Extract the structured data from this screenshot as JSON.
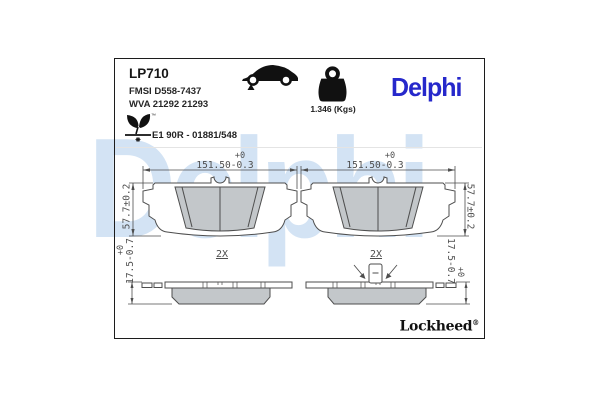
{
  "watermark": "Delphi",
  "header": {
    "part_number": "LP710",
    "fmsi": "FMSI D558-7437",
    "wva": "WVA 21292 21293",
    "weight": "1.346 (Kgs)",
    "brand_logo": "Delphi",
    "leaf_tm": "™",
    "approval": "E1 90R - 01881/548"
  },
  "drawing": {
    "width_tol_plus": "+0",
    "width_value": "151.50",
    "width_tol_minus": "-0.3",
    "height_value": "57.7±0.2",
    "thickness_tol_plus": "+0",
    "thickness_value": "17.5",
    "thickness_tol_minus": "-0.7",
    "quantity": "2X"
  },
  "footer": {
    "sub_brand": "Lockheed",
    "registered": "®"
  },
  "colors": {
    "logo_blue": "#2628cb",
    "watermark_blue": "#d3e3f4",
    "line_gray": "#4e4e4e",
    "friction_gray": "#c3c7ca"
  }
}
